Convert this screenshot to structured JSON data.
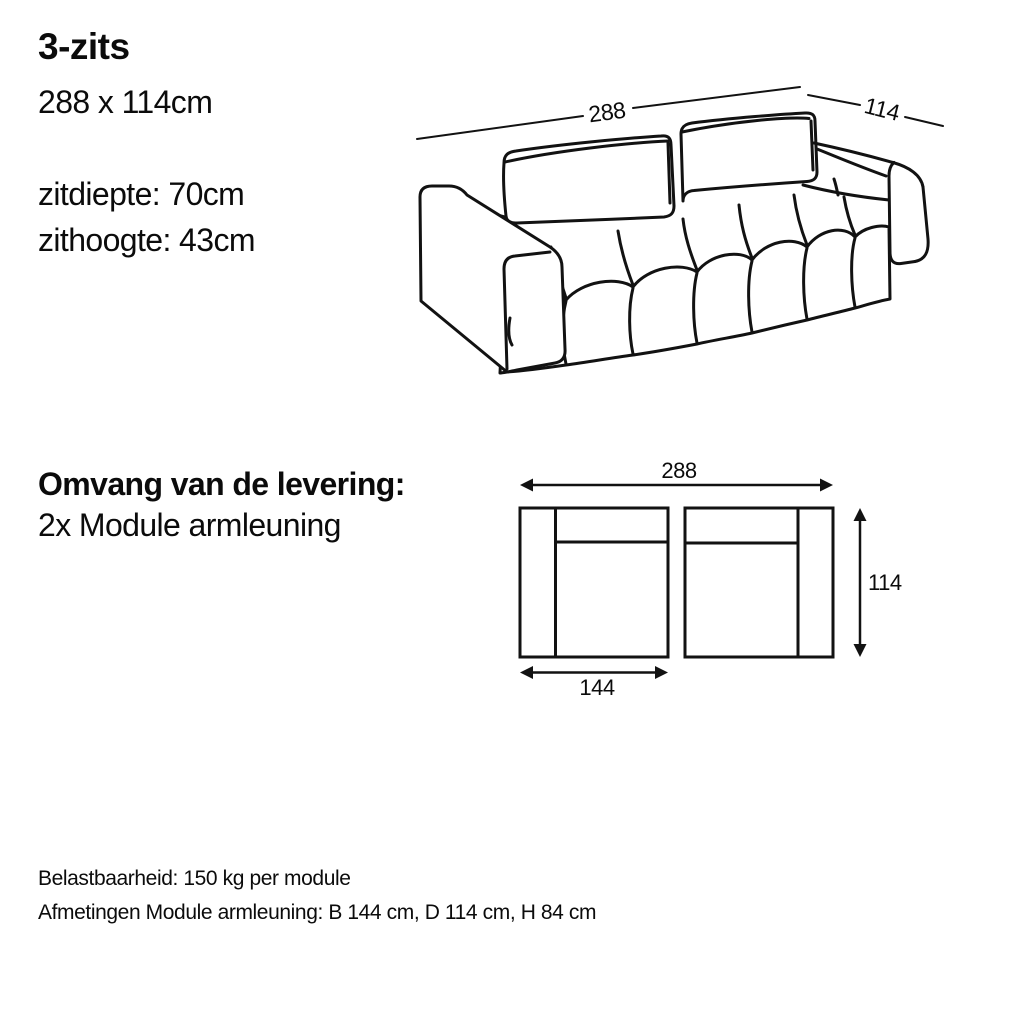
{
  "specs": {
    "title": "3-zits",
    "dimensions": "288 x 114cm",
    "seat_depth": "zitdiepte: 70cm",
    "seat_height": "zithoogte: 43cm"
  },
  "delivery": {
    "heading": "Omvang van de levering:",
    "items": [
      "2x Module armleuning"
    ]
  },
  "footer": {
    "load_capacity": "Belastbaarheid: 150 kg per module",
    "module_dimensions": "Afmetingen Module armleuning: B 144 cm, D 114 cm, H 84 cm"
  },
  "sofa_diagram": {
    "width_label": "288",
    "depth_label": "114"
  },
  "module_diagram": {
    "total_width_label": "288",
    "depth_label": "114",
    "module_width_label": "144"
  },
  "colors": {
    "line": "#121212",
    "background": "#ffffff",
    "text": "#0b0b0b"
  }
}
